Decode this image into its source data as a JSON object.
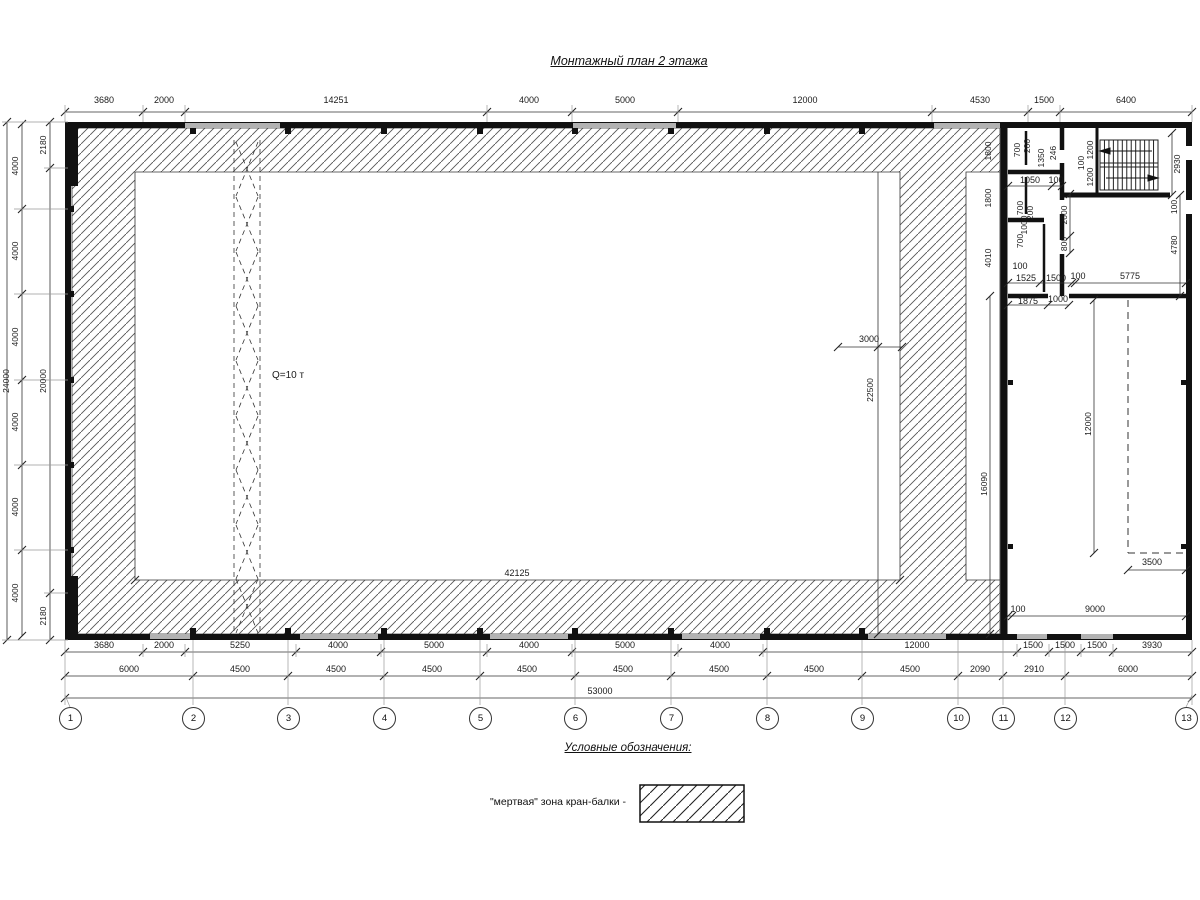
{
  "title": "Монтажный план 2 этажа",
  "legend": {
    "heading": "Условные обозначения:",
    "dead_zone_label": "\"мертвая\" зона кран-балки -"
  },
  "crane": {
    "capacity": "Q=10 т"
  },
  "hall": {
    "width": "42125",
    "offset": "3000",
    "dead_zone_height": "22500"
  },
  "grid_bubbles": [
    "1",
    "2",
    "3",
    "4",
    "5",
    "6",
    "7",
    "8",
    "9",
    "10",
    "11",
    "12",
    "13"
  ],
  "dims_top": [
    "3680",
    "2000",
    "14251",
    "4000",
    "5000",
    "12000",
    "4530",
    "1500",
    "6400"
  ],
  "dims_left": {
    "total": "24000",
    "bays": [
      "4000",
      "4000",
      "4000",
      "4000",
      "4000",
      "4000"
    ],
    "inner": [
      "2180",
      "20000",
      "2180"
    ]
  },
  "dims_bottom_row1": [
    "3680",
    "2000",
    "5250",
    "4000",
    "5000",
    "4000",
    "5000",
    "4000",
    "12000",
    "1500",
    "1500",
    "1500",
    "3930"
  ],
  "dims_bottom_row2": [
    "6000",
    "4500",
    "4500",
    "4500",
    "4500",
    "4500",
    "4500",
    "4500",
    "4500",
    "2090",
    "2910",
    "6000"
  ],
  "dims_bottom_total": "53000",
  "right_wing": [
    "1800",
    "1800",
    "4010",
    "16090",
    "700",
    "200",
    "1350",
    "246",
    "1050",
    "100",
    "700",
    "200",
    "1000",
    "700",
    "100",
    "1525",
    "1500",
    "100",
    "5775",
    "1875",
    "1000",
    "1200",
    "1200",
    "100",
    "2930",
    "100",
    "2000",
    "800",
    "4780",
    "12000",
    "3500",
    "100",
    "9000"
  ]
}
